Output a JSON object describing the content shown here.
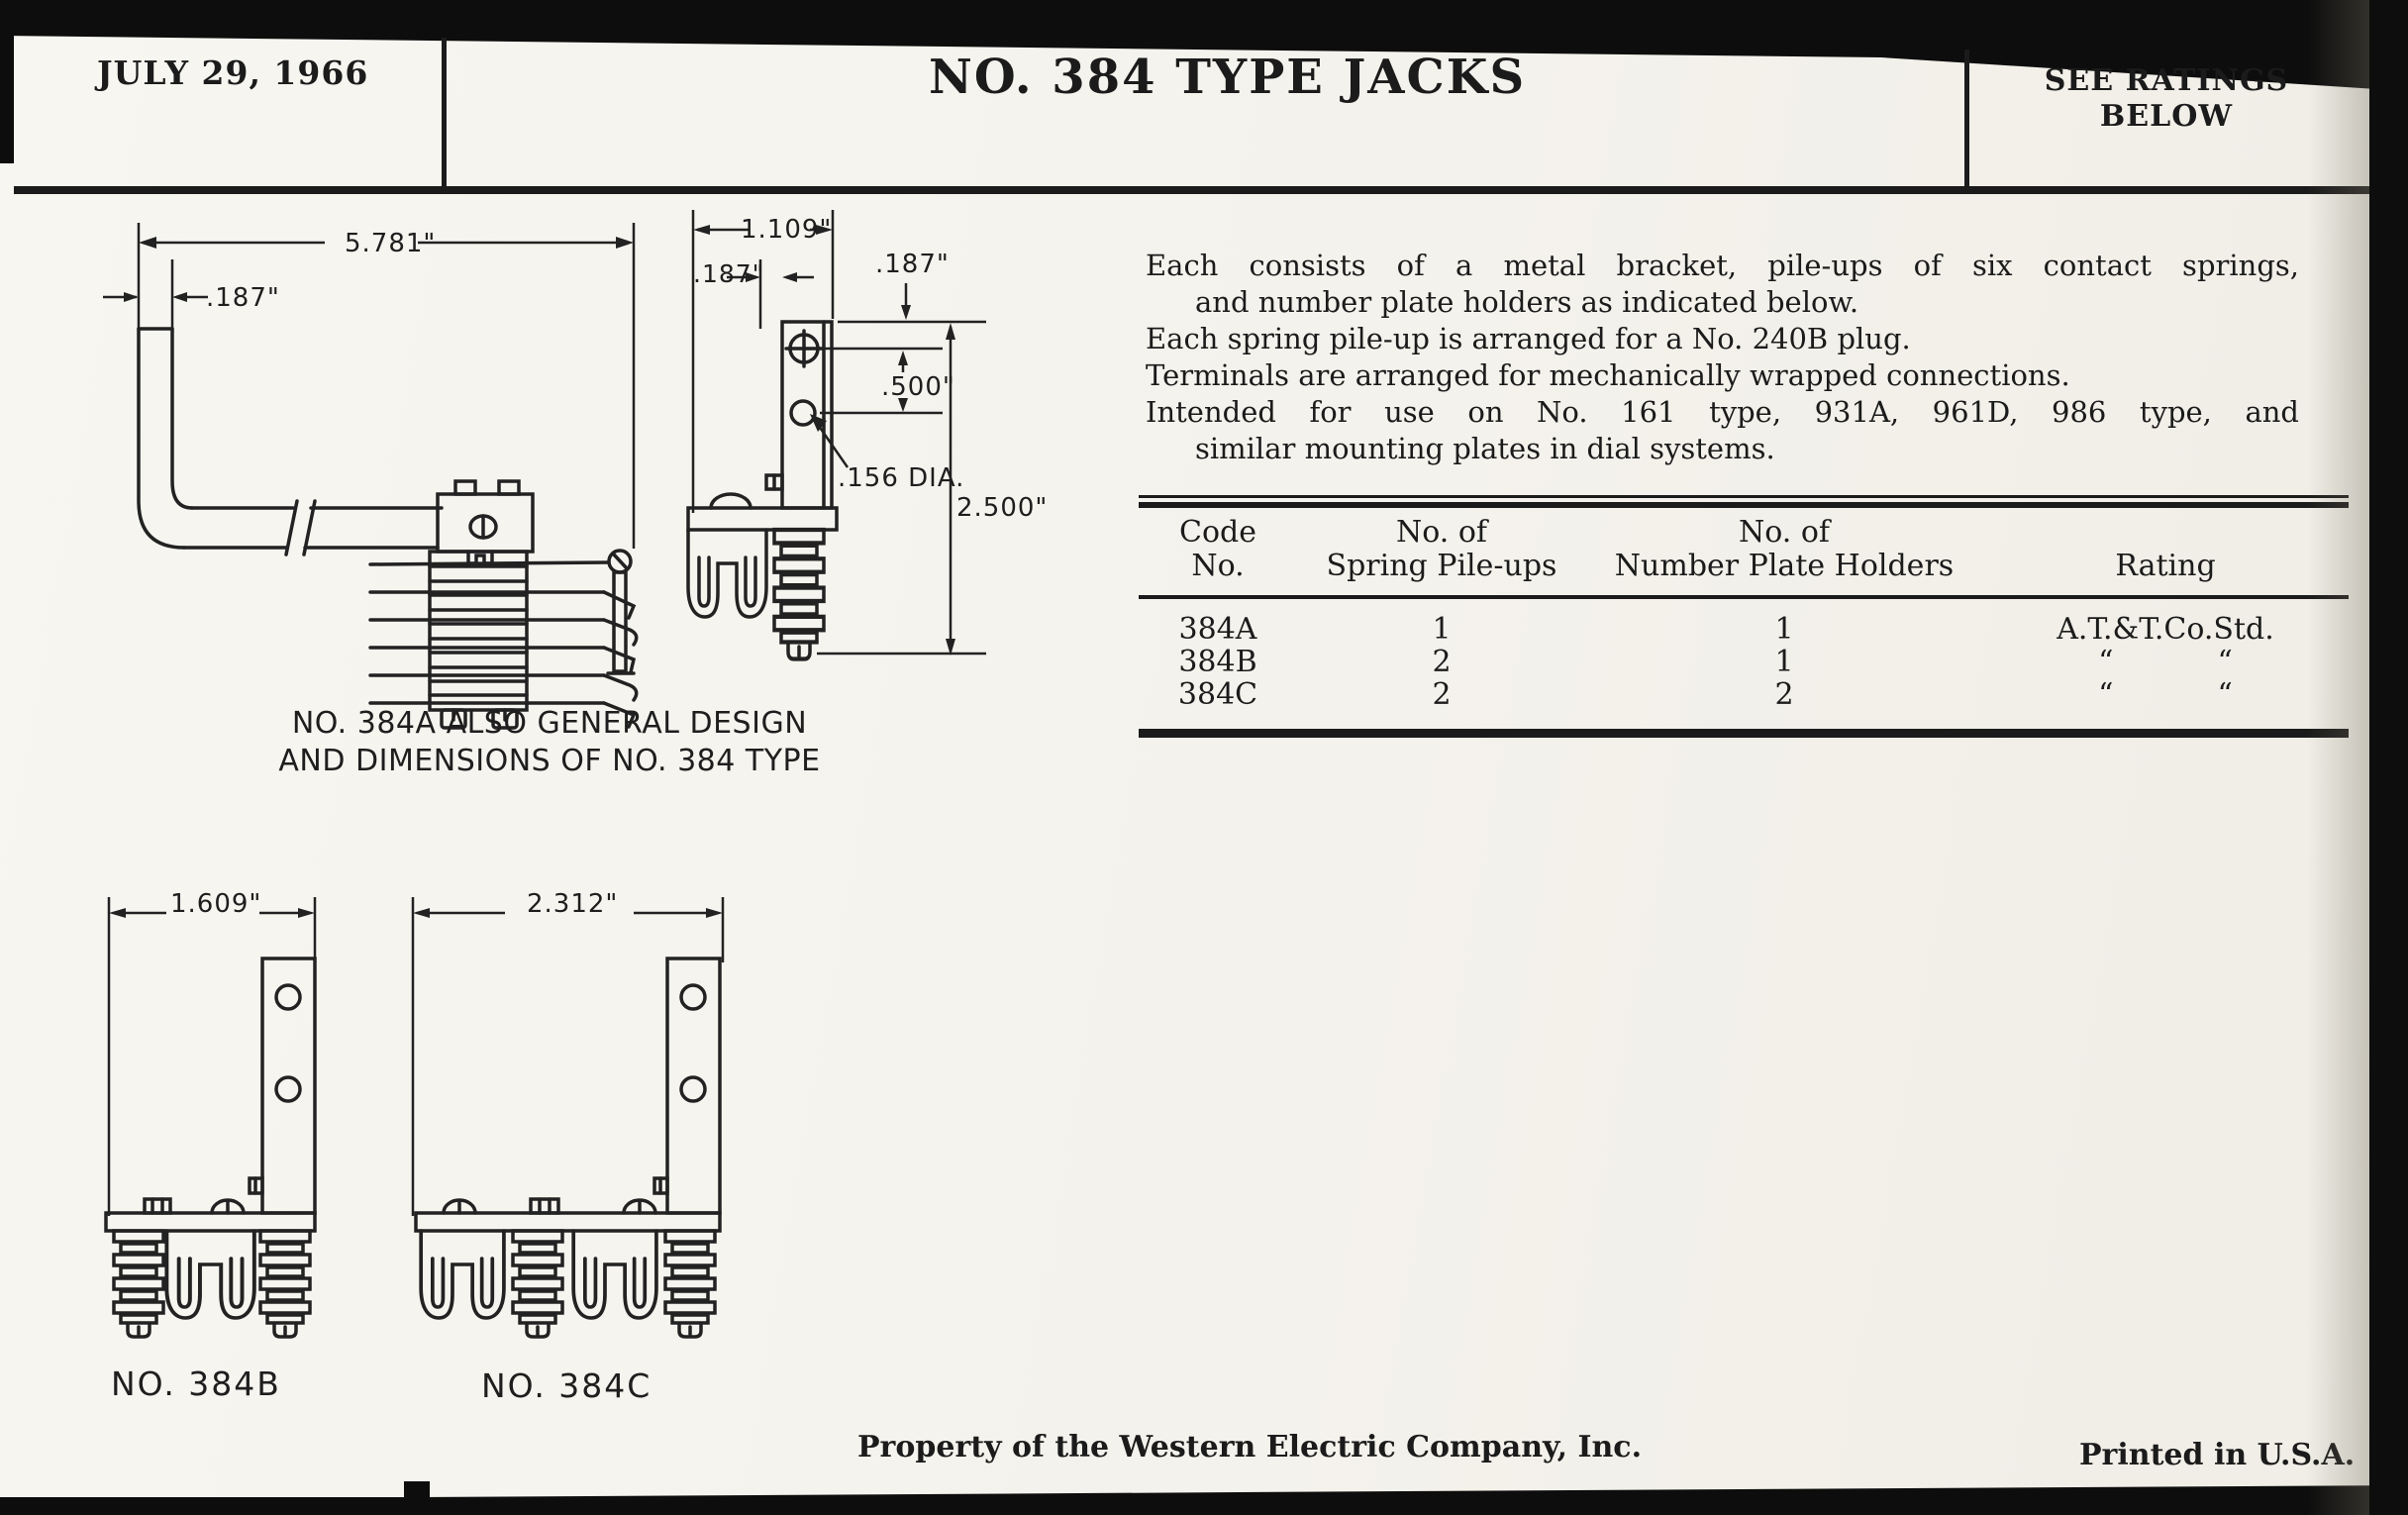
{
  "header": {
    "date": "JULY 29, 1966",
    "title": "NO. 384 TYPE JACKS",
    "ratings_note": [
      "SEE RATINGS",
      "BELOW"
    ]
  },
  "description": {
    "lines": [
      "Each consists of a metal bracket, pile-ups of six contact springs,",
      "and number plate holders as indicated below.",
      "Each spring pile-up is arranged for a No. 240B plug.",
      "Terminals are arranged for mechanically wrapped connections.",
      "Intended for use on No. 161 type, 931A, 961D, 986 type, and",
      "similar mounting plates in dial systems."
    ]
  },
  "ratings_table": {
    "col_headers": {
      "code": [
        "Code",
        "No."
      ],
      "pileups": [
        "No. of",
        "Spring Pile-ups"
      ],
      "holders": [
        "No. of",
        "Number Plate Holders"
      ],
      "rating": "Rating"
    },
    "rows": [
      {
        "code": "384A",
        "pileups": "1",
        "holders": "1",
        "rating": "A.T.&T.Co.Std."
      },
      {
        "code": "384B",
        "pileups": "2",
        "holders": "1"
      },
      {
        "code": "384C",
        "pileups": "2",
        "holders": "2"
      }
    ],
    "ditto_mark": "“"
  },
  "drawings": {
    "side_view": {
      "dim_length": "5.781\"",
      "dim_thickness": ".187\""
    },
    "end_view": {
      "dim_width": "1.109\"",
      "dim_left": ".187\"",
      "dim_top": ".187\"",
      "dim_hole_spacing": ".500\"",
      "dim_hole_dia": ".156 DIA.",
      "dim_height": "2.500\""
    },
    "caption": [
      "NO. 384A ALSO GENERAL DESIGN",
      "AND DIMENSIONS OF NO. 384 TYPE"
    ],
    "front_384b": {
      "dim_width": "1.609\"",
      "label": "NO. 384B"
    },
    "front_384c": {
      "dim_width": "2.312\"",
      "label": "NO. 384C"
    }
  },
  "footer": {
    "property_note": "Property of the Western Electric Company, Inc.",
    "printed_note": "Printed in U.S.A."
  }
}
